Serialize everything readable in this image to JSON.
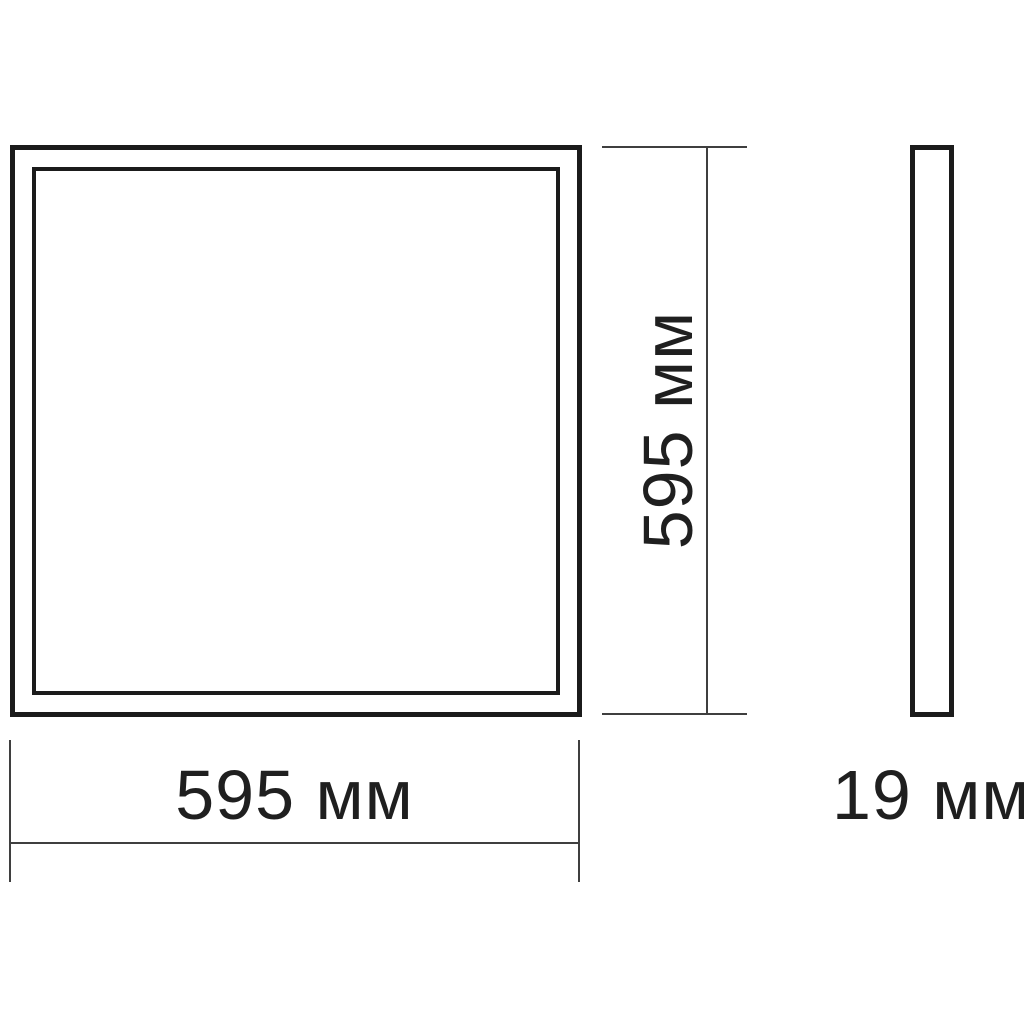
{
  "diagram": {
    "type": "technical-dimension-drawing",
    "views": {
      "front_view": "square panel with double frame",
      "side_view": "thin vertical profile"
    },
    "dimensions": {
      "width_label": "595 мм",
      "height_label": "595 мм",
      "depth_label": "19 мм"
    },
    "colors": {
      "background": "#ffffff",
      "outline": "#1b1b1b",
      "dimension_line": "#3f3f3f",
      "text": "#1f1f1f"
    }
  }
}
